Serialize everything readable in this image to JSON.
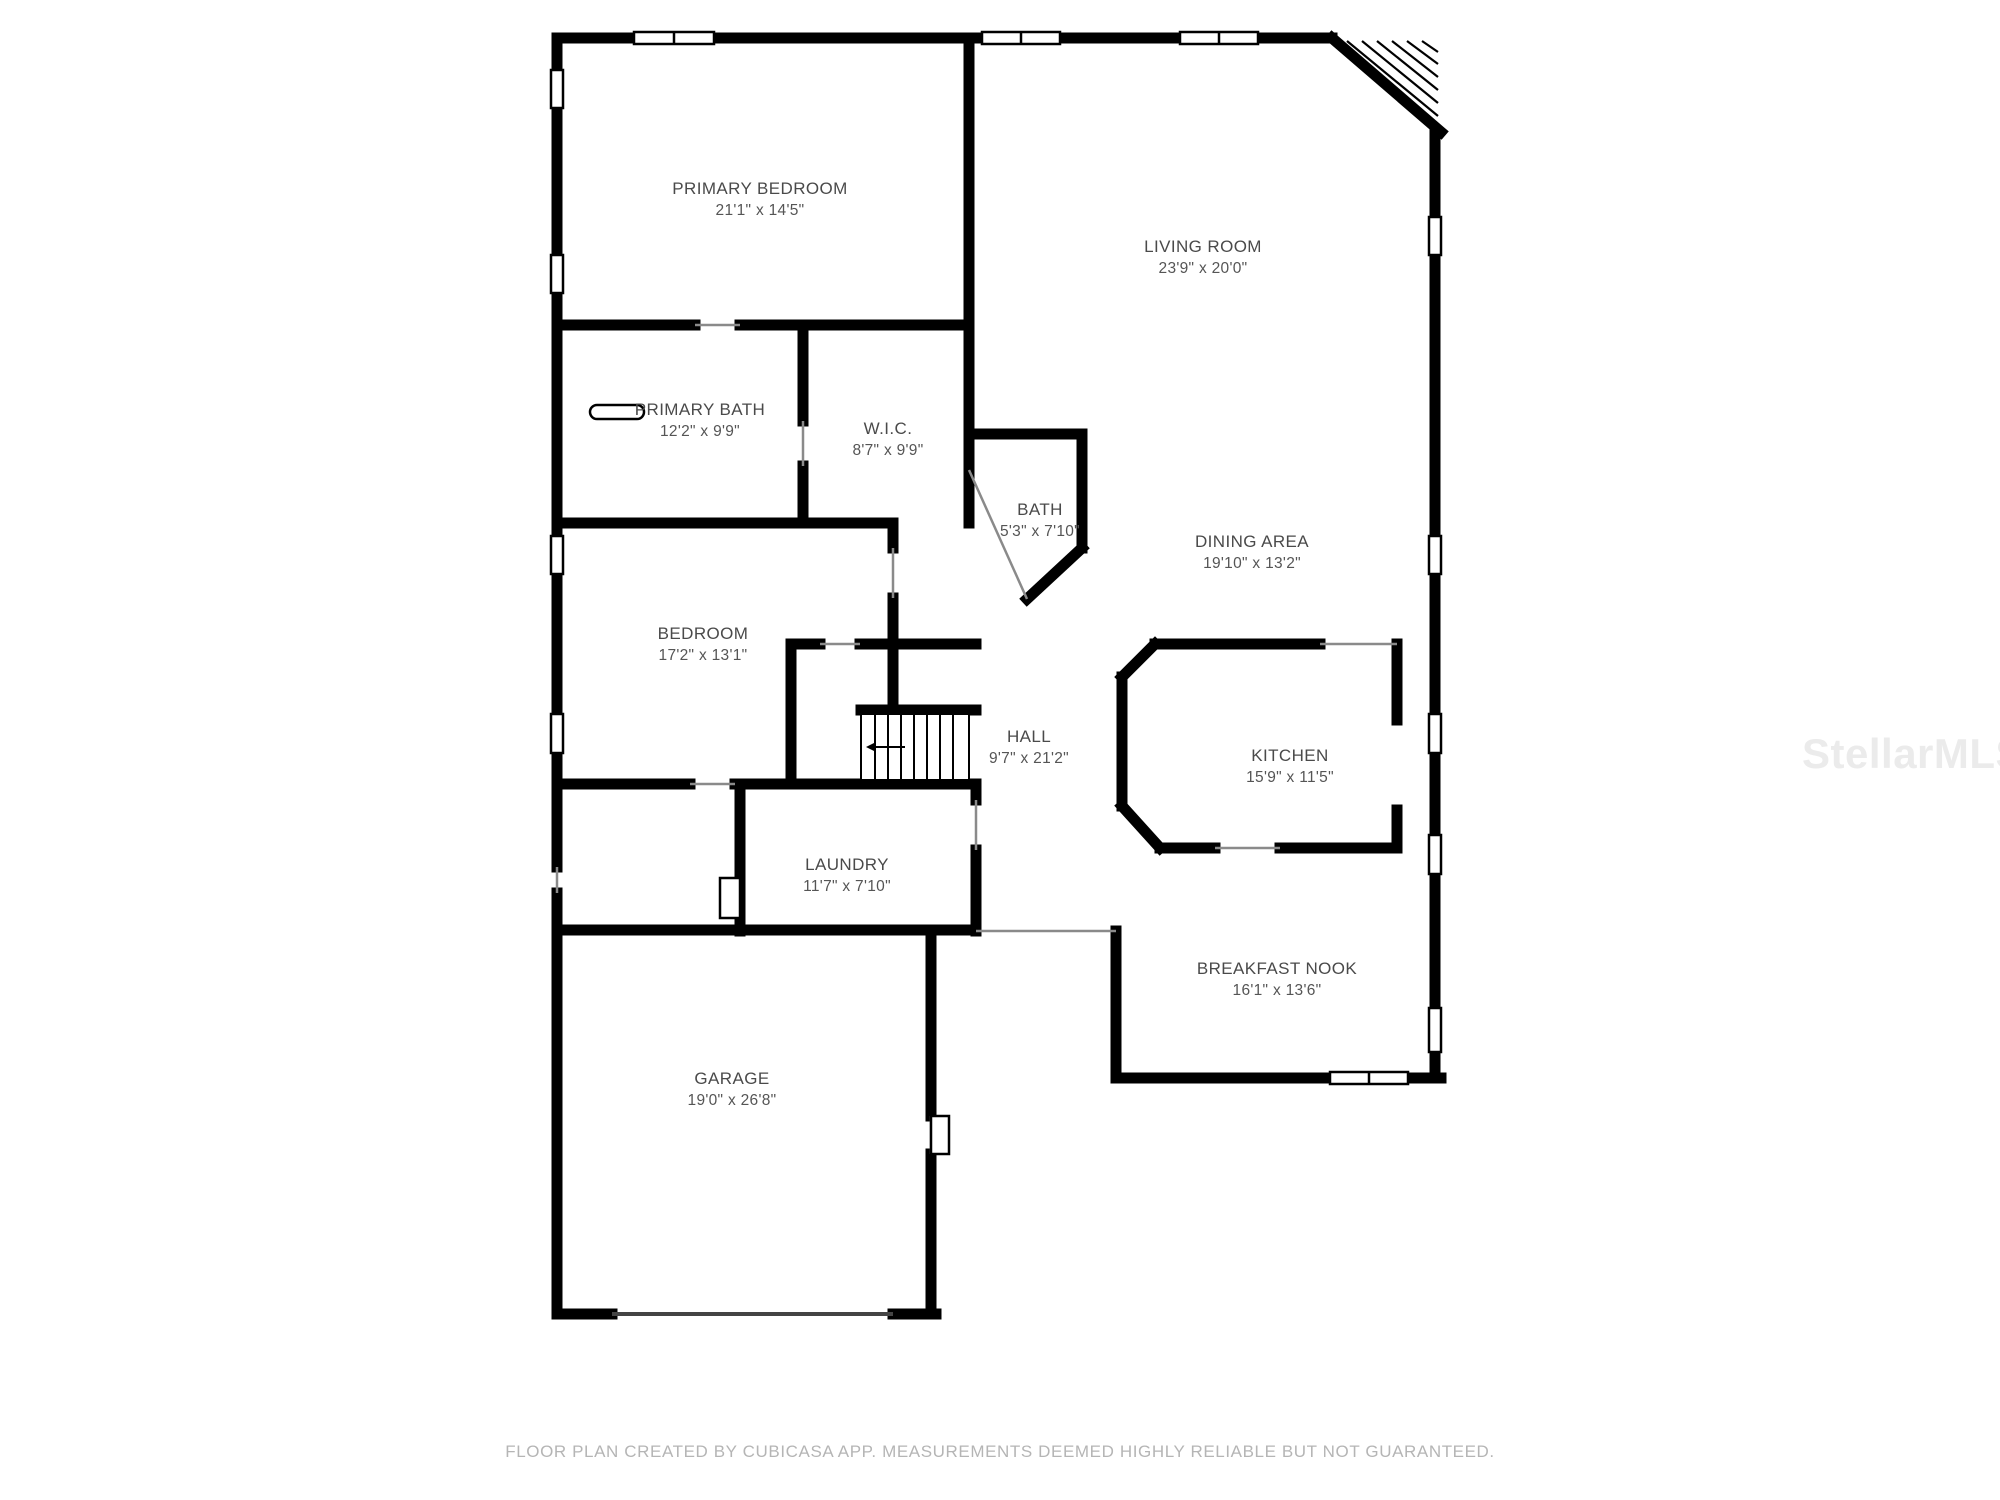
{
  "page": {
    "background": "#ffffff"
  },
  "colors": {
    "wall": "#000000",
    "label_text": "#4a4a4a",
    "footer_text": "#b5b5b5",
    "watermark_text": "#ebebeb",
    "window_fill": "#ffffff"
  },
  "watermark": {
    "text": "StellarMLS"
  },
  "footer": {
    "text": "FLOOR PLAN CREATED BY CUBICASA APP. MEASUREMENTS DEEMED HIGHLY RELIABLE BUT NOT GUARANTEED."
  },
  "rooms": [
    {
      "id": "primary-bedroom",
      "name": "PRIMARY BEDROOM",
      "dimensions": "21'1\" x 14'5\""
    },
    {
      "id": "living-room",
      "name": "LIVING ROOM",
      "dimensions": "23'9\" x 20'0\""
    },
    {
      "id": "primary-bath",
      "name": "PRIMARY BATH",
      "dimensions": "12'2\" x 9'9\""
    },
    {
      "id": "wic",
      "name": "W.I.C.",
      "dimensions": "8'7\" x 9'9\""
    },
    {
      "id": "bath",
      "name": "BATH",
      "dimensions": "5'3\" x 7'10\""
    },
    {
      "id": "dining-area",
      "name": "DINING AREA",
      "dimensions": "19'10\" x 13'2\""
    },
    {
      "id": "bedroom",
      "name": "BEDROOM",
      "dimensions": "17'2\" x 13'1\""
    },
    {
      "id": "hall",
      "name": "HALL",
      "dimensions": "9'7\" x 21'2\""
    },
    {
      "id": "kitchen",
      "name": "KITCHEN",
      "dimensions": "15'9\" x 11'5\""
    },
    {
      "id": "laundry",
      "name": "LAUNDRY",
      "dimensions": "11'7\" x 7'10\""
    },
    {
      "id": "breakfast-nook",
      "name": "BREAKFAST NOOK",
      "dimensions": "16'1\" x 13'6\""
    },
    {
      "id": "garage",
      "name": "GARAGE",
      "dimensions": "19'0\" x 26'8\""
    }
  ]
}
